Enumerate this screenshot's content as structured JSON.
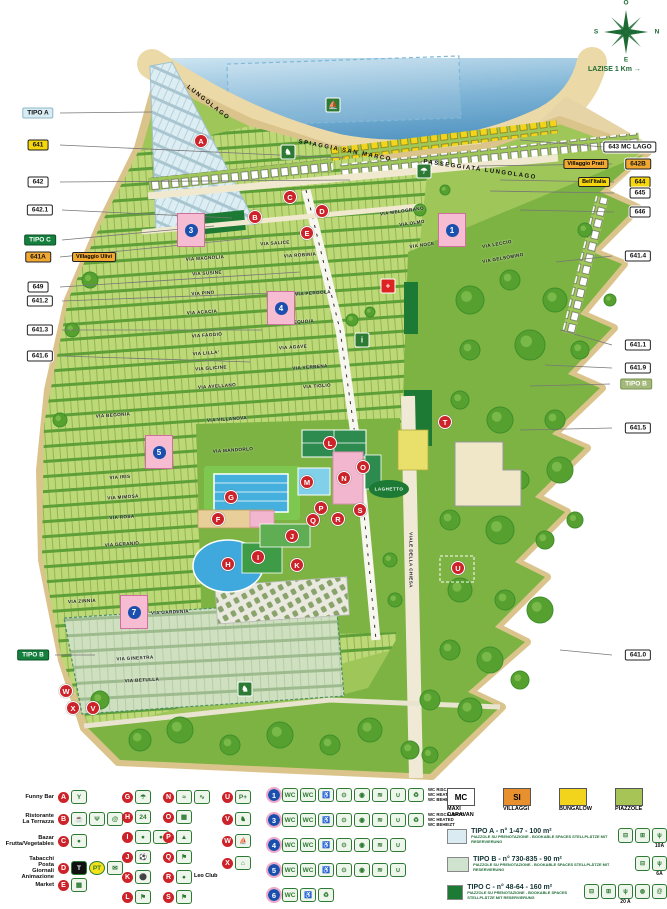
{
  "map": {
    "compass": {
      "top": "O",
      "left": "S",
      "right": "N",
      "bottom": "E"
    },
    "distance_label": "LAZISE 1 Km",
    "beach_labels": [
      {
        "text": "LUNGOLAGO",
        "x": 208,
        "y": 103,
        "rot": 38
      },
      {
        "text": "SPIAGGIA SAN MARCO",
        "x": 345,
        "y": 151,
        "rot": 11
      },
      {
        "text": "PASSEGGIATA LUNGOLAGO",
        "x": 480,
        "y": 170,
        "rot": 8
      }
    ],
    "area_labels": [
      {
        "text": "LAGHETTO",
        "x": 389,
        "y": 489,
        "rot": 0
      }
    ],
    "left_labels": [
      {
        "text": "TIPO A",
        "color": "tipoa",
        "x": 38,
        "y": 113,
        "tx": 152,
        "ty": 112
      },
      {
        "text": "641",
        "color": "yellow",
        "x": 38,
        "y": 145,
        "tx": 345,
        "ty": 158
      },
      {
        "text": "642",
        "color": "white",
        "x": 38,
        "y": 182,
        "tx": 350,
        "ty": 180
      },
      {
        "text": "642.1",
        "color": "white",
        "x": 40,
        "y": 210,
        "tx": 232,
        "ty": 218
      },
      {
        "text": "TIPO C",
        "color": "green",
        "x": 40,
        "y": 240,
        "tx": 214,
        "ty": 226
      },
      {
        "text": "641A",
        "color": "orange",
        "x": 38,
        "y": 257,
        "companion": "Villaggio Ulivi",
        "tx": 252,
        "ty": 238
      },
      {
        "text": "649",
        "color": "white",
        "x": 38,
        "y": 287,
        "tx": 300,
        "ty": 272
      },
      {
        "text": "641.2",
        "color": "white",
        "x": 40,
        "y": 301,
        "tx": 300,
        "ty": 292
      },
      {
        "text": "641.3",
        "color": "white",
        "x": 40,
        "y": 330,
        "tx": 262,
        "ty": 330
      },
      {
        "text": "641.6",
        "color": "white",
        "x": 40,
        "y": 356,
        "tx": 250,
        "ty": 362
      },
      {
        "text": "TIPO B",
        "color": "green",
        "x": 33,
        "y": 655,
        "tx": 95,
        "ty": 655
      }
    ],
    "right_labels": [
      {
        "text": "643 MC LAGO",
        "color": "white",
        "x": 630,
        "y": 147,
        "tx": 520,
        "ty": 140
      },
      {
        "text": "642B",
        "color": "orange",
        "x": 638,
        "y": 164,
        "companion": "Villaggio Prati",
        "tx": 478,
        "ty": 166
      },
      {
        "text": "644",
        "color": "yellow",
        "x": 640,
        "y": 182,
        "companion2": "Bell'Italia",
        "tx": 500,
        "ty": 180
      },
      {
        "text": "645",
        "color": "white",
        "x": 640,
        "y": 193,
        "tx": 490,
        "ty": 191
      },
      {
        "text": "646",
        "color": "white",
        "x": 640,
        "y": 212,
        "tx": 520,
        "ty": 210
      },
      {
        "text": "641.4",
        "color": "white",
        "x": 638,
        "y": 256,
        "tx": 556,
        "ty": 262
      },
      {
        "text": "641.1",
        "color": "white",
        "x": 638,
        "y": 345,
        "tx": 560,
        "ty": 330
      },
      {
        "text": "641.9",
        "color": "white",
        "x": 638,
        "y": 368,
        "tx": 545,
        "ty": 365
      },
      {
        "text": "TIPO B",
        "color": "paleg",
        "x": 636,
        "y": 384,
        "tx": 530,
        "ty": 386
      },
      {
        "text": "641.5",
        "color": "white",
        "x": 638,
        "y": 428,
        "tx": 520,
        "ty": 430
      },
      {
        "text": "641.0",
        "color": "white",
        "x": 638,
        "y": 655,
        "tx": 560,
        "ty": 650
      }
    ],
    "streets": [
      {
        "name": "VIA SALICE",
        "x": 275,
        "y": 243,
        "rot": -4
      },
      {
        "name": "VIA MAGNOLIA",
        "x": 205,
        "y": 258,
        "rot": -4
      },
      {
        "name": "VIA SUSINE",
        "x": 207,
        "y": 273,
        "rot": -4
      },
      {
        "name": "VIA PINO",
        "x": 203,
        "y": 293,
        "rot": -4
      },
      {
        "name": "VIA ACACIA",
        "x": 202,
        "y": 312,
        "rot": -4
      },
      {
        "name": "VIA FAGGIO",
        "x": 207,
        "y": 335,
        "rot": -4
      },
      {
        "name": "VIA LILLA'",
        "x": 206,
        "y": 353,
        "rot": -4
      },
      {
        "name": "VIA GLICINE",
        "x": 211,
        "y": 368,
        "rot": -4
      },
      {
        "name": "VIA AVELLANO",
        "x": 217,
        "y": 386,
        "rot": -4
      },
      {
        "name": "VIA ROBINIA",
        "x": 300,
        "y": 255,
        "rot": -4
      },
      {
        "name": "VIA PERGOLA",
        "x": 313,
        "y": 293,
        "rot": -4
      },
      {
        "name": "VIA SEQUOIA",
        "x": 297,
        "y": 322,
        "rot": -4
      },
      {
        "name": "VIA AGAVE",
        "x": 293,
        "y": 347,
        "rot": -4
      },
      {
        "name": "VIA VERBENA",
        "x": 310,
        "y": 367,
        "rot": -4
      },
      {
        "name": "VIA TIGLIO",
        "x": 317,
        "y": 386,
        "rot": -4
      },
      {
        "name": "VIA BEGONIA",
        "x": 113,
        "y": 415,
        "rot": -4
      },
      {
        "name": "VIA VILLANOVA",
        "x": 227,
        "y": 419,
        "rot": -4
      },
      {
        "name": "VIA MANDORLO",
        "x": 233,
        "y": 450,
        "rot": -4
      },
      {
        "name": "VIA IRIS",
        "x": 120,
        "y": 477,
        "rot": -4
      },
      {
        "name": "VIA MIMOSA",
        "x": 123,
        "y": 497,
        "rot": -4
      },
      {
        "name": "VIA ROSA",
        "x": 122,
        "y": 517,
        "rot": -4
      },
      {
        "name": "VIA GERANIO",
        "x": 122,
        "y": 544,
        "rot": -4
      },
      {
        "name": "VIA ZINNIA",
        "x": 82,
        "y": 601,
        "rot": -3
      },
      {
        "name": "VIA GARDENIA",
        "x": 170,
        "y": 612,
        "rot": -3
      },
      {
        "name": "VIA GINESTRA",
        "x": 135,
        "y": 658,
        "rot": -3
      },
      {
        "name": "VIA BETULLA",
        "x": 142,
        "y": 680,
        "rot": -3
      },
      {
        "name": "VIA MELOGRANO",
        "x": 402,
        "y": 211,
        "rot": -8
      },
      {
        "name": "VIA OLMO",
        "x": 412,
        "y": 223,
        "rot": -8
      },
      {
        "name": "VIA NOCE",
        "x": 422,
        "y": 245,
        "rot": -8
      },
      {
        "name": "VIA LECCIO",
        "x": 497,
        "y": 244,
        "rot": -10
      },
      {
        "name": "VIA GELSOMINO",
        "x": 503,
        "y": 258,
        "rot": -10
      },
      {
        "name": "VIALE DELLA CHIESA",
        "x": 411,
        "y": 560,
        "rot": 90
      }
    ],
    "amenities": [
      {
        "letter": "A",
        "x": 201,
        "y": 141
      },
      {
        "letter": "B",
        "x": 255,
        "y": 217
      },
      {
        "letter": "C",
        "x": 290,
        "y": 197
      },
      {
        "letter": "D",
        "x": 322,
        "y": 211
      },
      {
        "letter": "E",
        "x": 307,
        "y": 233
      },
      {
        "letter": "F",
        "x": 218,
        "y": 519
      },
      {
        "letter": "G",
        "x": 231,
        "y": 497
      },
      {
        "letter": "H",
        "x": 228,
        "y": 564
      },
      {
        "letter": "I",
        "x": 258,
        "y": 557
      },
      {
        "letter": "J",
        "x": 292,
        "y": 536
      },
      {
        "letter": "K",
        "x": 297,
        "y": 565
      },
      {
        "letter": "L",
        "x": 330,
        "y": 443
      },
      {
        "letter": "M",
        "x": 307,
        "y": 482
      },
      {
        "letter": "N",
        "x": 344,
        "y": 478
      },
      {
        "letter": "O",
        "x": 363,
        "y": 467
      },
      {
        "letter": "P",
        "x": 321,
        "y": 508
      },
      {
        "letter": "Q",
        "x": 313,
        "y": 520
      },
      {
        "letter": "R",
        "x": 338,
        "y": 519
      },
      {
        "letter": "S",
        "x": 360,
        "y": 510
      },
      {
        "letter": "T",
        "x": 445,
        "y": 422
      },
      {
        "letter": "U",
        "x": 458,
        "y": 568
      },
      {
        "letter": "V",
        "x": 93,
        "y": 708
      },
      {
        "letter": "W",
        "x": 66,
        "y": 691
      },
      {
        "letter": "X",
        "x": 73,
        "y": 708
      }
    ],
    "wc_blocks": [
      {
        "num": "1",
        "x": 452,
        "y": 230
      },
      {
        "num": "3",
        "x": 191,
        "y": 230
      },
      {
        "num": "4",
        "x": 281,
        "y": 308
      },
      {
        "num": "5",
        "x": 159,
        "y": 452
      },
      {
        "num": "7",
        "x": 134,
        "y": 612
      }
    ],
    "facilities": [
      {
        "icon": "info",
        "glyph": "i",
        "x": 362,
        "y": 340
      },
      {
        "icon": "first-aid",
        "glyph": "+",
        "x": 388,
        "y": 286,
        "red": true
      },
      {
        "icon": "dog-beach",
        "glyph": "♞",
        "x": 288,
        "y": 152
      },
      {
        "icon": "pier",
        "glyph": "⛵",
        "x": 333,
        "y": 105
      },
      {
        "icon": "horse-riding",
        "glyph": "♞",
        "x": 245,
        "y": 689
      },
      {
        "icon": "beach-service",
        "glyph": "☂",
        "x": 424,
        "y": 171
      }
    ]
  },
  "legend": {
    "services": [
      {
        "letter": "A",
        "label": "Funny Bar",
        "icons": [
          "cocktail"
        ]
      },
      {
        "letter": "B",
        "label": "Ristorante\nLa Terrazza",
        "icons": [
          "coffee",
          "cutlery",
          "at"
        ]
      },
      {
        "letter": "C",
        "label": "Bazar\nFrutta/Vegetables",
        "icons": [
          "apple"
        ]
      },
      {
        "letter": "D",
        "label": "Tabacchi\nPosta\nGiornali\nAnimazione",
        "icons": [
          "tabacchi",
          "pt",
          "news"
        ]
      },
      {
        "letter": "E",
        "label": "Market",
        "icons": [
          "cart"
        ]
      }
    ],
    "letters2": [
      {
        "letter": "G",
        "icons": [
          "beach"
        ]
      },
      {
        "letter": "H",
        "icons": [
          "clock24"
        ]
      },
      {
        "letter": "I",
        "icons": [
          "sport",
          "sport"
        ]
      },
      {
        "letter": "J",
        "icons": [
          "soccer"
        ]
      },
      {
        "letter": "K",
        "icons": [
          "bocce"
        ]
      },
      {
        "letter": "L",
        "icons": [
          "tennis"
        ]
      }
    ],
    "letters3": [
      {
        "letter": "N",
        "icons": [
          "pool",
          "slide"
        ]
      },
      {
        "letter": "O",
        "icons": [
          "stalls"
        ]
      },
      {
        "letter": "P",
        "icons": [
          "playground"
        ]
      },
      {
        "letter": "Q",
        "icons": [
          "gym"
        ]
      },
      {
        "letter": "R",
        "icons": [
          "leo"
        ],
        "label": "Leo\nClub"
      },
      {
        "letter": "S",
        "icons": [
          "minigolf"
        ]
      }
    ],
    "letters4": [
      {
        "letter": "U",
        "icons": [
          "charging"
        ]
      },
      {
        "letter": "V",
        "icons": [
          "horse"
        ]
      },
      {
        "letter": "W",
        "icons": [
          "boat"
        ]
      },
      {
        "letter": "X",
        "icons": [
          "camper"
        ]
      }
    ],
    "wc_rows": [
      {
        "num": "1",
        "icons": [
          "wc",
          "wcchem",
          "wheelchair",
          "baby",
          "washer",
          "dryer",
          "sink",
          "waste"
        ],
        "note": "WC RISCALDATO\nWC HEATED\nWC BEHEIZT"
      },
      {
        "num": "3",
        "icons": [
          "wc",
          "wcchem",
          "wheelchair",
          "baby",
          "washer",
          "dryer",
          "sink",
          "waste"
        ],
        "note": "WC RISCALDATO\nWC HEATED\nWC BEHEIZT"
      },
      {
        "num": "4",
        "icons": [
          "wc",
          "wcchem",
          "wheelchair",
          "baby",
          "washer",
          "dryer",
          "sink"
        ],
        "note": ""
      },
      {
        "num": "5",
        "icons": [
          "wc",
          "wcchem",
          "wheelchair",
          "baby",
          "washer",
          "dryer",
          "sink"
        ],
        "note": ""
      },
      {
        "num": "6",
        "icons": [
          "wc",
          "wheelchair",
          "waste"
        ],
        "note": ""
      }
    ],
    "swatches": [
      {
        "code": "MC",
        "label": "MAXI\nCARAVAN",
        "color": "#ffffff"
      },
      {
        "code": "SI",
        "label": "VILLAGGI",
        "color": "#e8902e"
      },
      {
        "code": "",
        "label": "BUNGALOW",
        "color": "#f2d41c"
      },
      {
        "code": "",
        "label": "PIAZZOLE",
        "color": "#a6c556"
      }
    ],
    "tipo_rows": [
      {
        "swatch": "#daecf2",
        "title": "TIPO A - n° 1-47 - 100 m²",
        "sub": "PIAZZOLE SU PRENOTAZIONE - BOOKABLE SPACES\nSTELLPLÄTZE MIT RESERVIERUNG",
        "amps": "10A",
        "icons": [
          "car",
          "caravan",
          "plug"
        ]
      },
      {
        "swatch": "#cfe3cf",
        "title": "TIPO B - n° 730-835 - 90 m²",
        "sub": "PIAZZOLE SU PRENOTAZIONE - BOOKABLE SPACES\nSTELLPLÄTZE MIT RESERVIERUNG",
        "amps": "6A",
        "icons": [
          "car",
          "plug"
        ]
      },
      {
        "swatch": "#1d7a35",
        "title": "TIPO C - n° 48-64 - 160 m²",
        "sub": "PIAZZOLE SU PRENOTAZIONE - BOOKABLE SPACES\nSTELLPLÄTZE MIT RESERVIERUNG",
        "amps": "20 A",
        "icons": [
          "car",
          "caravan",
          "plug",
          "sat",
          "at"
        ]
      },
      {
        "swatch": "#8fbf4d",
        "title": "TIPO D - n° 8..-8.. - 110 m²",
        "sub": "PIAZZOLE SU PRENOTAZIONE - BOOKABLE SPACES\nSTELLPLÄTZE MIT RESERVIERUNG",
        "amps": "",
        "icons": [
          "car",
          "plug"
        ]
      }
    ]
  }
}
